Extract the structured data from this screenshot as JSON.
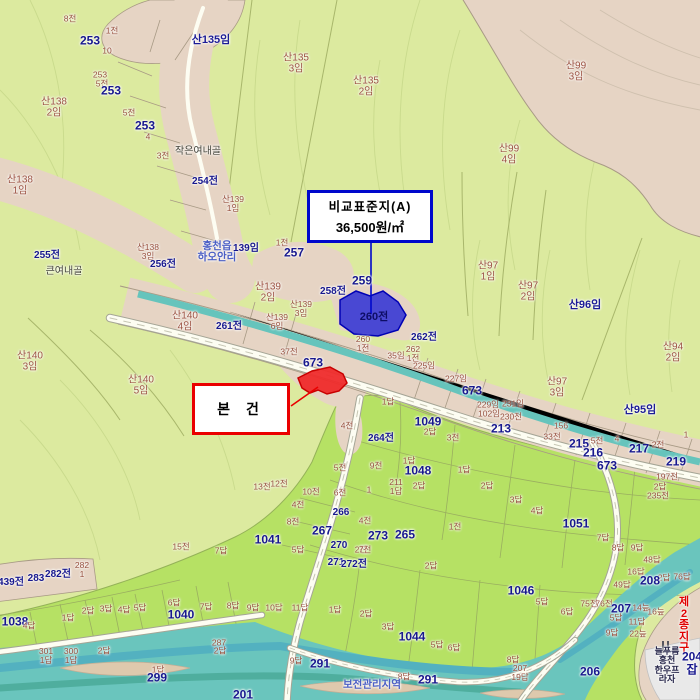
{
  "annotations": {
    "comparison_box": {
      "title": "비교표준지(A)",
      "price": "36,500원/㎡"
    },
    "subject_box": {
      "label": "본 건"
    }
  },
  "legend_colors": {
    "forest": "#dcea9f",
    "paddy": "#b6e164",
    "village": "#e6d4c4",
    "water": "#6ac5bd",
    "road": "#fdfdf2",
    "comparison_parcel": "#3c3cd4",
    "subject_parcel": "#ef2b2b",
    "parcel_number_text": "#18188e",
    "sub_parcel_text": "#97503e"
  },
  "labels": [
    {
      "t": "8전",
      "x": 70,
      "y": 19,
      "c": "m"
    },
    {
      "t": "1전",
      "x": 112,
      "y": 31,
      "c": "m"
    },
    {
      "t": "253",
      "x": 90,
      "y": 41,
      "c": "n1"
    },
    {
      "t": "10",
      "x": 107,
      "y": 51,
      "c": "m"
    },
    {
      "t": "산135임",
      "x": 211,
      "y": 41,
      "c": "sn"
    },
    {
      "t": "산135\n3임",
      "x": 296,
      "y": 64,
      "c": "m2"
    },
    {
      "t": "산135\n2임",
      "x": 366,
      "y": 87,
      "c": "m2"
    },
    {
      "t": "산99\n3임",
      "x": 576,
      "y": 72,
      "c": "m2"
    },
    {
      "t": "253",
      "x": 100,
      "y": 75,
      "c": "m"
    },
    {
      "t": "5전",
      "x": 102,
      "y": 84,
      "c": "m"
    },
    {
      "t": "253",
      "x": 111,
      "y": 91,
      "c": "n1"
    },
    {
      "t": "산138\n2임",
      "x": 54,
      "y": 108,
      "c": "m2"
    },
    {
      "t": "5전",
      "x": 129,
      "y": 113,
      "c": "m"
    },
    {
      "t": "253",
      "x": 145,
      "y": 126,
      "c": "n1"
    },
    {
      "t": "4",
      "x": 148,
      "y": 137,
      "c": "m"
    },
    {
      "t": "산99\n4임",
      "x": 509,
      "y": 155,
      "c": "m2"
    },
    {
      "t": "3전",
      "x": 163,
      "y": 156,
      "c": "m"
    },
    {
      "t": "작은여내골",
      "x": 198,
      "y": 152,
      "c": "blk"
    },
    {
      "t": "산138\n1임",
      "x": 20,
      "y": 186,
      "c": "m2"
    },
    {
      "t": "254전",
      "x": 205,
      "y": 182,
      "c": "n2"
    },
    {
      "t": "산139\n1임",
      "x": 233,
      "y": 204,
      "c": "m"
    },
    {
      "t": "255전",
      "x": 47,
      "y": 256,
      "c": "n2"
    },
    {
      "t": "큰여내골",
      "x": 64,
      "y": 272,
      "c": "blk"
    },
    {
      "t": "산138\n3임",
      "x": 148,
      "y": 252,
      "c": "m"
    },
    {
      "t": "256전",
      "x": 163,
      "y": 265,
      "c": "n2"
    },
    {
      "t": "홍천읍\n하오안리",
      "x": 217,
      "y": 252,
      "c": "pl"
    },
    {
      "t": "139임",
      "x": 246,
      "y": 249,
      "c": "n2"
    },
    {
      "t": "1전",
      "x": 282,
      "y": 243,
      "c": "m"
    },
    {
      "t": "257",
      "x": 294,
      "y": 253,
      "c": "n1"
    },
    {
      "t": "산97\n1임",
      "x": 488,
      "y": 272,
      "c": "m2"
    },
    {
      "t": "산97\n2임",
      "x": 528,
      "y": 292,
      "c": "m2"
    },
    {
      "t": "산96임",
      "x": 585,
      "y": 306,
      "c": "sn"
    },
    {
      "t": "산139\n2임",
      "x": 268,
      "y": 293,
      "c": "m2"
    },
    {
      "t": "259",
      "x": 362,
      "y": 281,
      "c": "n1"
    },
    {
      "t": "258전",
      "x": 333,
      "y": 292,
      "c": "n2"
    },
    {
      "t": "산139\n3임",
      "x": 301,
      "y": 309,
      "c": "m"
    },
    {
      "t": "260전",
      "x": 374,
      "y": 318,
      "c": "nb"
    },
    {
      "t": "산140\n4임",
      "x": 185,
      "y": 322,
      "c": "m2"
    },
    {
      "t": "261전",
      "x": 229,
      "y": 327,
      "c": "n2"
    },
    {
      "t": "산139\n6임",
      "x": 277,
      "y": 322,
      "c": "m"
    },
    {
      "t": "260\n1전",
      "x": 363,
      "y": 344,
      "c": "m"
    },
    {
      "t": "262전",
      "x": 424,
      "y": 338,
      "c": "n2"
    },
    {
      "t": "262\n1전",
      "x": 413,
      "y": 354,
      "c": "m"
    },
    {
      "t": "35임",
      "x": 396,
      "y": 356,
      "c": "m"
    },
    {
      "t": "225임",
      "x": 424,
      "y": 366,
      "c": "m"
    },
    {
      "t": "산94\n2임",
      "x": 673,
      "y": 353,
      "c": "m2"
    },
    {
      "t": "37전",
      "x": 289,
      "y": 352,
      "c": "m"
    },
    {
      "t": "673",
      "x": 313,
      "y": 363,
      "c": "n1"
    },
    {
      "t": "산140\n3임",
      "x": 30,
      "y": 362,
      "c": "m2"
    },
    {
      "t": "산140\n5임",
      "x": 141,
      "y": 386,
      "c": "m2"
    },
    {
      "t": "227임",
      "x": 456,
      "y": 379,
      "c": "m"
    },
    {
      "t": "673",
      "x": 472,
      "y": 391,
      "c": "n1"
    },
    {
      "t": "산97\n3임",
      "x": 557,
      "y": 388,
      "c": "m2"
    },
    {
      "t": "산95임",
      "x": 640,
      "y": 411,
      "c": "sn"
    },
    {
      "t": "1답",
      "x": 388,
      "y": 402,
      "c": "m"
    },
    {
      "t": "229임",
      "x": 488,
      "y": 405,
      "c": "m"
    },
    {
      "t": "231임",
      "x": 513,
      "y": 404,
      "c": "m"
    },
    {
      "t": "102임",
      "x": 489,
      "y": 414,
      "c": "m"
    },
    {
      "t": "230전",
      "x": 511,
      "y": 417,
      "c": "m"
    },
    {
      "t": "4전",
      "x": 347,
      "y": 426,
      "c": "m"
    },
    {
      "t": "1049",
      "x": 428,
      "y": 422,
      "c": "n1"
    },
    {
      "t": "2답",
      "x": 430,
      "y": 432,
      "c": "m"
    },
    {
      "t": "213",
      "x": 501,
      "y": 429,
      "c": "n1"
    },
    {
      "t": "3전",
      "x": 453,
      "y": 438,
      "c": "m"
    },
    {
      "t": "264전",
      "x": 381,
      "y": 439,
      "c": "n2"
    },
    {
      "t": "156",
      "x": 561,
      "y": 426,
      "c": "m"
    },
    {
      "t": "33전",
      "x": 552,
      "y": 437,
      "c": "m"
    },
    {
      "t": "5전",
      "x": 597,
      "y": 441,
      "c": "m"
    },
    {
      "t": "215",
      "x": 579,
      "y": 444,
      "c": "n1"
    },
    {
      "t": "4",
      "x": 617,
      "y": 439,
      "c": "m"
    },
    {
      "t": "1",
      "x": 686,
      "y": 435,
      "c": "m"
    },
    {
      "t": "2전",
      "x": 658,
      "y": 445,
      "c": "m"
    },
    {
      "t": "217",
      "x": 639,
      "y": 449,
      "c": "n1"
    },
    {
      "t": "216",
      "x": 593,
      "y": 453,
      "c": "n1"
    },
    {
      "t": "219",
      "x": 676,
      "y": 462,
      "c": "n1"
    },
    {
      "t": "673",
      "x": 607,
      "y": 466,
      "c": "n1"
    },
    {
      "t": "9전",
      "x": 376,
      "y": 466,
      "c": "m"
    },
    {
      "t": "5전",
      "x": 340,
      "y": 468,
      "c": "m"
    },
    {
      "t": "1답",
      "x": 409,
      "y": 461,
      "c": "m"
    },
    {
      "t": "1답",
      "x": 464,
      "y": 470,
      "c": "m"
    },
    {
      "t": "1048",
      "x": 418,
      "y": 471,
      "c": "n1"
    },
    {
      "t": "197전",
      "x": 667,
      "y": 477,
      "c": "m"
    },
    {
      "t": "2답",
      "x": 419,
      "y": 486,
      "c": "m"
    },
    {
      "t": "2답",
      "x": 487,
      "y": 486,
      "c": "m"
    },
    {
      "t": "2답",
      "x": 660,
      "y": 487,
      "c": "m"
    },
    {
      "t": "235전",
      "x": 658,
      "y": 496,
      "c": "m"
    },
    {
      "t": "13전",
      "x": 262,
      "y": 487,
      "c": "m"
    },
    {
      "t": "12전",
      "x": 279,
      "y": 484,
      "c": "m"
    },
    {
      "t": "10전",
      "x": 311,
      "y": 492,
      "c": "m"
    },
    {
      "t": "6전",
      "x": 340,
      "y": 493,
      "c": "m"
    },
    {
      "t": "1",
      "x": 369,
      "y": 490,
      "c": "m"
    },
    {
      "t": "211\n1답",
      "x": 396,
      "y": 487,
      "c": "m"
    },
    {
      "t": "3답",
      "x": 516,
      "y": 500,
      "c": "m"
    },
    {
      "t": "4답",
      "x": 537,
      "y": 511,
      "c": "m"
    },
    {
      "t": "4전",
      "x": 298,
      "y": 505,
      "c": "m"
    },
    {
      "t": "266",
      "x": 341,
      "y": 513,
      "c": "n2"
    },
    {
      "t": "8전",
      "x": 293,
      "y": 522,
      "c": "m"
    },
    {
      "t": "4전",
      "x": 365,
      "y": 521,
      "c": "m"
    },
    {
      "t": "1전",
      "x": 455,
      "y": 527,
      "c": "m"
    },
    {
      "t": "267",
      "x": 322,
      "y": 531,
      "c": "n1"
    },
    {
      "t": "273",
      "x": 378,
      "y": 536,
      "c": "n1"
    },
    {
      "t": "265",
      "x": 405,
      "y": 535,
      "c": "n1"
    },
    {
      "t": "1041",
      "x": 268,
      "y": 540,
      "c": "n1"
    },
    {
      "t": "1051",
      "x": 576,
      "y": 524,
      "c": "n1"
    },
    {
      "t": "7답",
      "x": 603,
      "y": 538,
      "c": "m"
    },
    {
      "t": "270",
      "x": 339,
      "y": 546,
      "c": "n2"
    },
    {
      "t": "2전",
      "x": 361,
      "y": 550,
      "c": "m"
    },
    {
      "t": "5답",
      "x": 298,
      "y": 550,
      "c": "m"
    },
    {
      "t": "7전",
      "x": 365,
      "y": 550,
      "c": "m"
    },
    {
      "t": "8답",
      "x": 618,
      "y": 548,
      "c": "m"
    },
    {
      "t": "9답",
      "x": 637,
      "y": 548,
      "c": "m"
    },
    {
      "t": "15전",
      "x": 181,
      "y": 547,
      "c": "m"
    },
    {
      "t": "7답",
      "x": 221,
      "y": 551,
      "c": "m"
    },
    {
      "t": "48답",
      "x": 652,
      "y": 560,
      "c": "m"
    },
    {
      "t": "271",
      "x": 336,
      "y": 563,
      "c": "n2"
    },
    {
      "t": "272전",
      "x": 354,
      "y": 565,
      "c": "n2"
    },
    {
      "t": "2답",
      "x": 431,
      "y": 566,
      "c": "m"
    },
    {
      "t": "282\n1",
      "x": 82,
      "y": 570,
      "c": "m"
    },
    {
      "t": "282전",
      "x": 58,
      "y": 575,
      "c": "n2"
    },
    {
      "t": "283",
      "x": 36,
      "y": 579,
      "c": "n2"
    },
    {
      "t": "439전",
      "x": 11,
      "y": 583,
      "c": "n2"
    },
    {
      "t": "16답",
      "x": 636,
      "y": 572,
      "c": "m"
    },
    {
      "t": "76답",
      "x": 682,
      "y": 577,
      "c": "m"
    },
    {
      "t": "2답",
      "x": 664,
      "y": 578,
      "c": "m"
    },
    {
      "t": "208",
      "x": 650,
      "y": 581,
      "c": "n1"
    },
    {
      "t": "49답",
      "x": 622,
      "y": 585,
      "c": "m"
    },
    {
      "t": "1046",
      "x": 521,
      "y": 591,
      "c": "n1"
    },
    {
      "t": "5답",
      "x": 542,
      "y": 602,
      "c": "m"
    },
    {
      "t": "75전",
      "x": 589,
      "y": 604,
      "c": "m"
    },
    {
      "t": "76전",
      "x": 604,
      "y": 604,
      "c": "m"
    },
    {
      "t": "6답",
      "x": 174,
      "y": 603,
      "c": "m"
    },
    {
      "t": "8답",
      "x": 233,
      "y": 606,
      "c": "m"
    },
    {
      "t": "7답",
      "x": 206,
      "y": 607,
      "c": "m"
    },
    {
      "t": "3답",
      "x": 106,
      "y": 609,
      "c": "m"
    },
    {
      "t": "4답",
      "x": 124,
      "y": 610,
      "c": "m"
    },
    {
      "t": "5답",
      "x": 140,
      "y": 608,
      "c": "m"
    },
    {
      "t": "2답",
      "x": 88,
      "y": 611,
      "c": "m"
    },
    {
      "t": "6답",
      "x": 567,
      "y": 612,
      "c": "m"
    },
    {
      "t": "207",
      "x": 621,
      "y": 609,
      "c": "n1"
    },
    {
      "t": "14늪",
      "x": 641,
      "y": 608,
      "c": "m"
    },
    {
      "t": "16늪",
      "x": 656,
      "y": 612,
      "c": "m"
    },
    {
      "t": "9답",
      "x": 253,
      "y": 608,
      "c": "m"
    },
    {
      "t": "10답",
      "x": 274,
      "y": 608,
      "c": "m"
    },
    {
      "t": "11답",
      "x": 300,
      "y": 608,
      "c": "m"
    },
    {
      "t": "1답",
      "x": 335,
      "y": 610,
      "c": "m"
    },
    {
      "t": "2답",
      "x": 366,
      "y": 614,
      "c": "m"
    },
    {
      "t": "1040",
      "x": 181,
      "y": 615,
      "c": "n1"
    },
    {
      "t": "5답",
      "x": 616,
      "y": 618,
      "c": "m"
    },
    {
      "t": "1답",
      "x": 68,
      "y": 618,
      "c": "m"
    },
    {
      "t": "1038",
      "x": 15,
      "y": 622,
      "c": "n1"
    },
    {
      "t": "4답",
      "x": 29,
      "y": 626,
      "c": "m"
    },
    {
      "t": "11답",
      "x": 637,
      "y": 622,
      "c": "m"
    },
    {
      "t": "제2종지구",
      "x": 684,
      "y": 626,
      "c": "redlbl"
    },
    {
      "t": "3답",
      "x": 388,
      "y": 627,
      "c": "m"
    },
    {
      "t": "9답",
      "x": 612,
      "y": 633,
      "c": "m"
    },
    {
      "t": "22늪",
      "x": 638,
      "y": 634,
      "c": "m"
    },
    {
      "t": "1044",
      "x": 412,
      "y": 637,
      "c": "n1"
    },
    {
      "t": "287",
      "x": 219,
      "y": 643,
      "c": "m"
    },
    {
      "t": "5답",
      "x": 437,
      "y": 645,
      "c": "m"
    },
    {
      "t": "6답",
      "x": 454,
      "y": 648,
      "c": "m"
    },
    {
      "t": "2답",
      "x": 220,
      "y": 651,
      "c": "m"
    },
    {
      "t": "2답",
      "x": 104,
      "y": 651,
      "c": "m"
    },
    {
      "t": "301\n1답",
      "x": 46,
      "y": 656,
      "c": "m"
    },
    {
      "t": "300\n1답",
      "x": 71,
      "y": 656,
      "c": "m"
    },
    {
      "t": "9답",
      "x": 296,
      "y": 661,
      "c": "m"
    },
    {
      "t": "291",
      "x": 320,
      "y": 664,
      "c": "n1"
    },
    {
      "t": "8답",
      "x": 513,
      "y": 660,
      "c": "m"
    },
    {
      "t": "늘푸름홍천\n한우프라자",
      "x": 667,
      "y": 666,
      "c": "poi"
    },
    {
      "t": "204잡",
      "x": 692,
      "y": 663,
      "c": "n1"
    },
    {
      "t": "1답",
      "x": 158,
      "y": 670,
      "c": "m"
    },
    {
      "t": "299",
      "x": 157,
      "y": 678,
      "c": "n1"
    },
    {
      "t": "207\n19답",
      "x": 520,
      "y": 673,
      "c": "m"
    },
    {
      "t": "206",
      "x": 590,
      "y": 672,
      "c": "n1"
    },
    {
      "t": "8답",
      "x": 404,
      "y": 677,
      "c": "m"
    },
    {
      "t": "291",
      "x": 428,
      "y": 680,
      "c": "n1"
    },
    {
      "t": "보전관리지역",
      "x": 372,
      "y": 685,
      "c": "pl"
    },
    {
      "t": "201",
      "x": 243,
      "y": 695,
      "c": "n1"
    }
  ]
}
